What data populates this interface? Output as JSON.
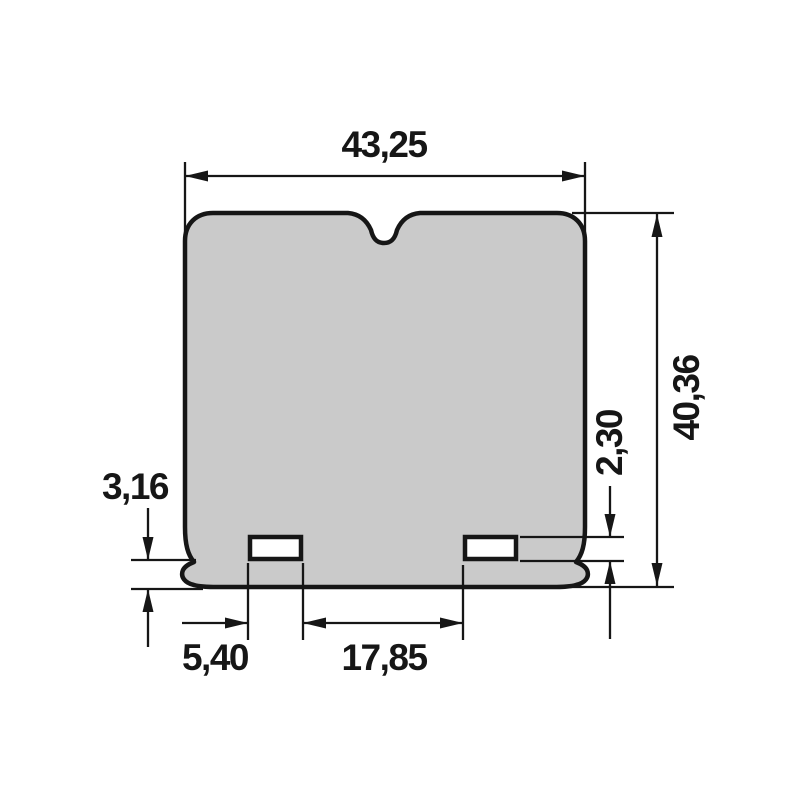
{
  "drawing": {
    "dimensions": {
      "overall_width": "43,25",
      "overall_height": "40,36",
      "slot_height": "2,30",
      "bottom_offset": "3,16",
      "slot_width": "5,40",
      "slot_spacing": "17,85"
    },
    "colors": {
      "part_fill": "#cacaca",
      "slot_fill": "#ffffff",
      "line": "#161616",
      "background": "#ffffff"
    }
  }
}
